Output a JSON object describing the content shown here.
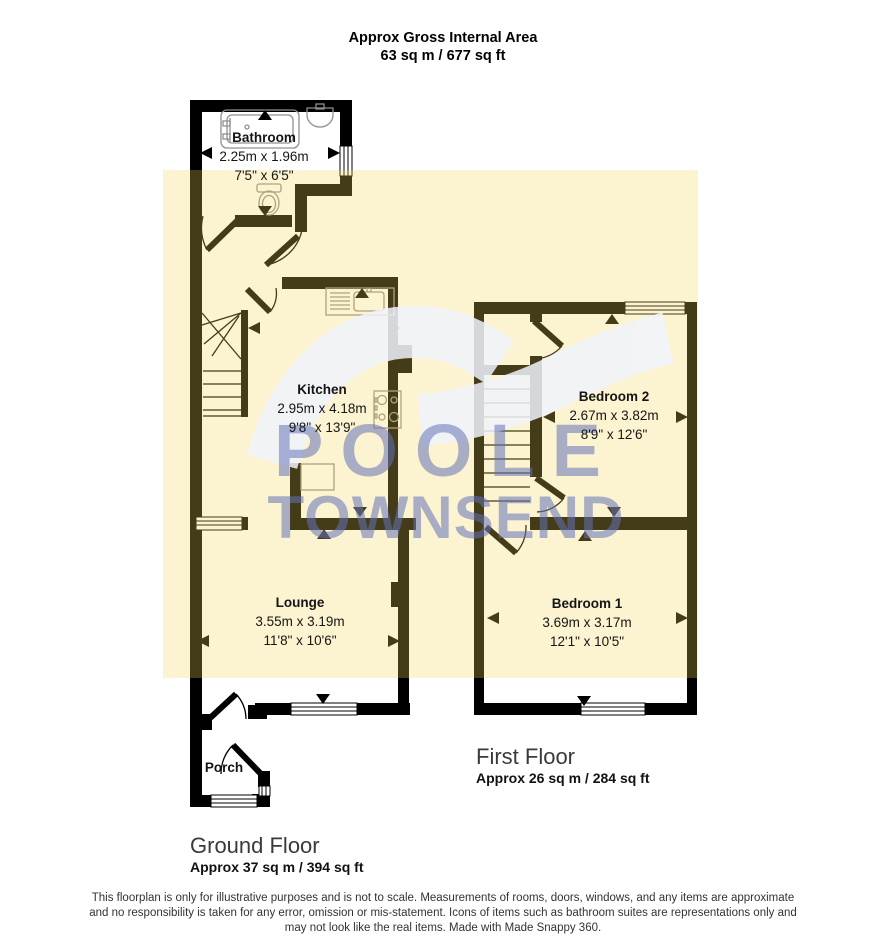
{
  "title": {
    "line1": "Approx Gross Internal Area",
    "line2": "63 sq m / 677 sq ft"
  },
  "watermark": {
    "line1": "POOLE",
    "line2": "TOWNSEND"
  },
  "ground_floor": {
    "label": "Ground Floor",
    "area": "Approx 37 sq m / 394 sq ft",
    "rooms": {
      "bathroom": {
        "name": "Bathroom",
        "metric": "2.25m x 1.96m",
        "imperial": "7'5\" x 6'5\""
      },
      "kitchen": {
        "name": "Kitchen",
        "metric": "2.95m x 4.18m",
        "imperial": "9'8\" x 13'9\""
      },
      "lounge": {
        "name": "Lounge",
        "metric": "3.55m x 3.19m",
        "imperial": "11'8\" x 10'6\""
      },
      "porch": {
        "name": "Porch"
      }
    }
  },
  "first_floor": {
    "label": "First Floor",
    "area": "Approx 26 sq m / 284 sq ft",
    "rooms": {
      "bedroom2": {
        "name": "Bedroom 2",
        "metric": "2.67m x 3.82m",
        "imperial": "8'9\" x 12'6\""
      },
      "bedroom1": {
        "name": "Bedroom 1",
        "metric": "3.69m x 3.17m",
        "imperial": "12'1\" x 10'5\""
      }
    }
  },
  "disclaimer": {
    "line1": "This floorplan is only for illustrative purposes and is not to scale. Measurements of rooms, doors, windows, and any items are approximate",
    "line2": "and no responsibility is taken for any error, omission or mis-statement. Icons of items such as bathroom suites are representations only and",
    "line3": "may not look like the real items. Made with Made Snappy 360."
  },
  "colors": {
    "highlight_overlay": "#FAF3D2",
    "wall": "#000000",
    "watermark_text": "#6C7AB9",
    "fixture_outline": "#909090"
  }
}
